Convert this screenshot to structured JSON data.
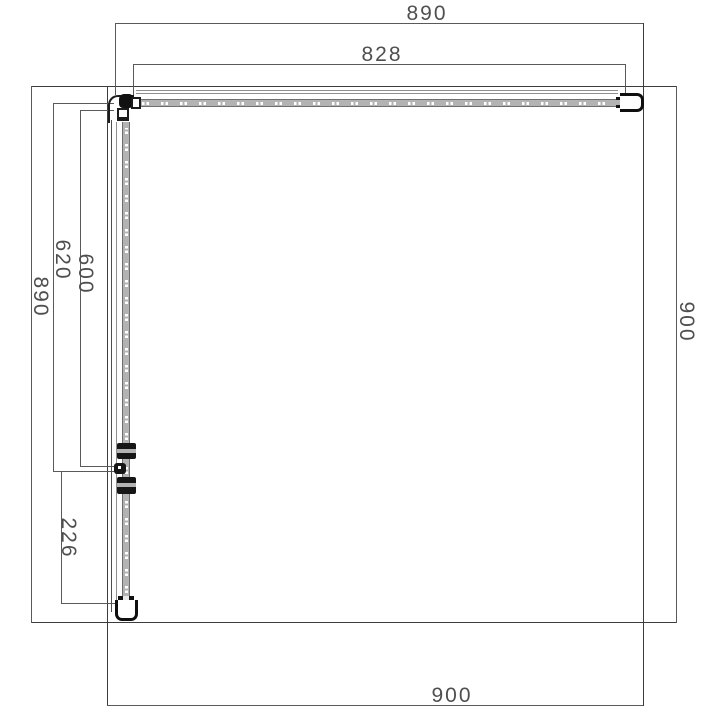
{
  "dimensions": {
    "top_overall": "890",
    "top_glass": "828",
    "left_overall": "890",
    "left_to_hinge": "620",
    "left_glass": "600",
    "left_bottom": "226",
    "right_overall": "900",
    "bottom_overall": "900"
  }
}
